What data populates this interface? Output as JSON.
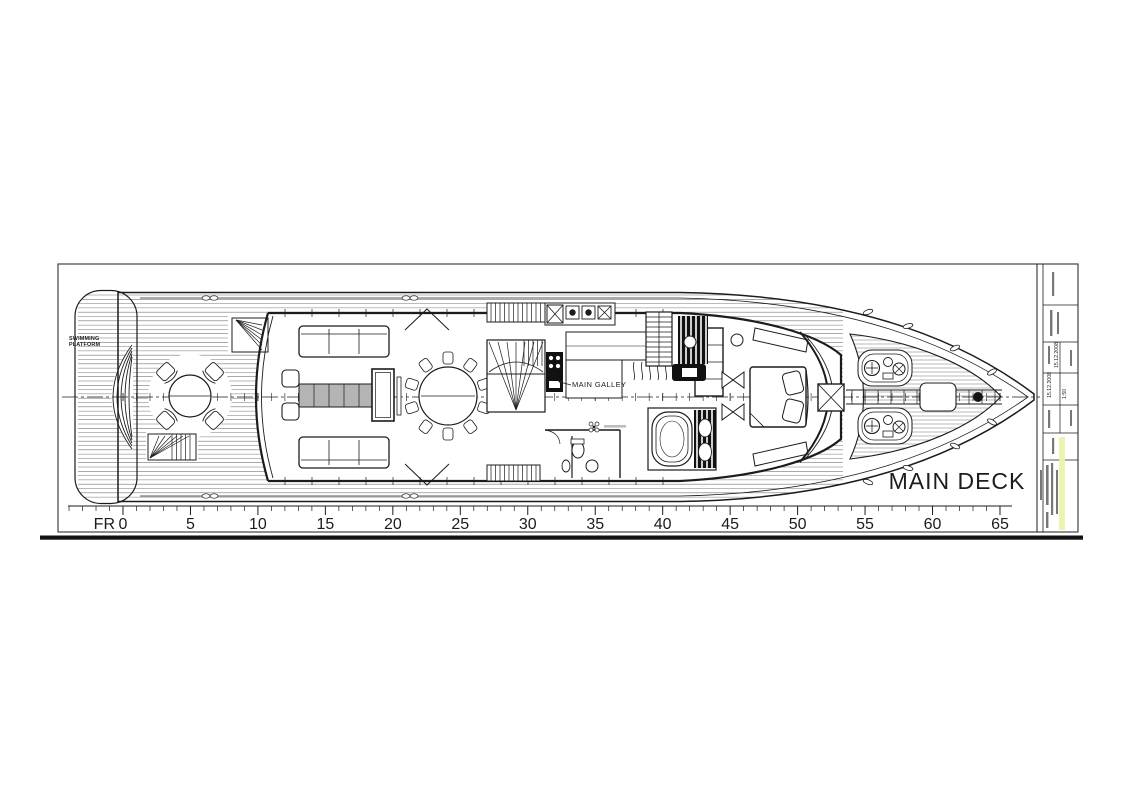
{
  "plan": {
    "deck_label": "MAIN DECK",
    "galley_label": "MAIN GALLEY",
    "swim_platform_label": [
      "SWIMMING",
      "PLATFORM"
    ],
    "ruler": {
      "prefix": "FR",
      "start": 0,
      "end": 65,
      "label_step": 5,
      "unit_labels": [
        "0",
        "5",
        "10",
        "15",
        "20",
        "25",
        "30",
        "35",
        "40",
        "45",
        "50",
        "55",
        "60",
        "65"
      ]
    },
    "title_block": {
      "date_a": "15.12.2008",
      "date_b": "15.12.2008",
      "scale": "1:50"
    },
    "colors": {
      "ink": "#1c1c1c",
      "plank": "#777777",
      "shade": "#b4b4b4",
      "highlight": "#edf2ae"
    }
  }
}
